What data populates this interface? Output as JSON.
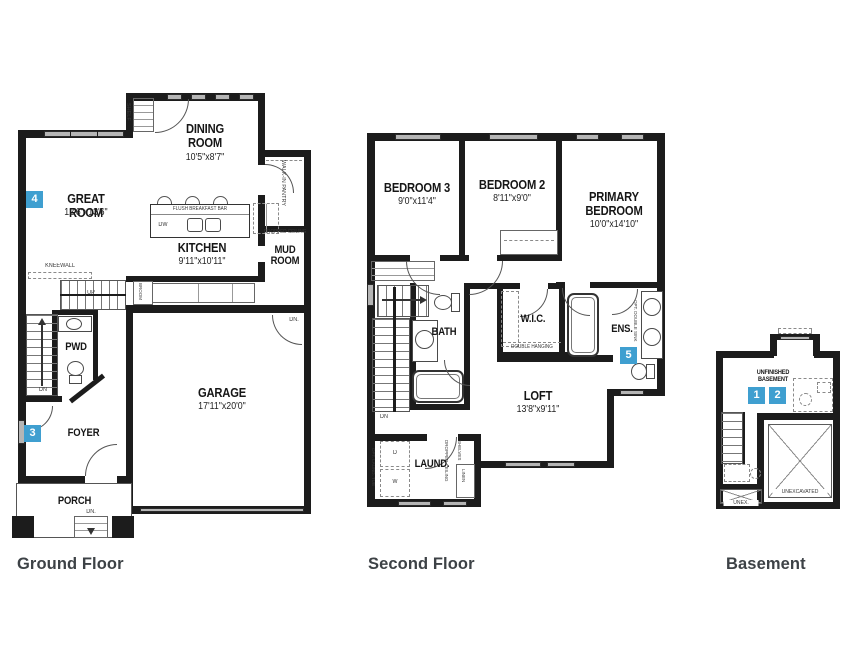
{
  "colors": {
    "wall": "#1c1c1c",
    "badge_blue": "#3f9fd0",
    "window_gray": "#b5b5b5",
    "title_gray": "#3d4246"
  },
  "floors": {
    "ground": {
      "title": "Ground Floor",
      "rooms": {
        "dining": {
          "name": "DINING\nROOM",
          "dims": "10'5\"x8'7\""
        },
        "great": {
          "badge": "4",
          "name": "GREAT ROOM",
          "dims": "12'6\"x13'6\""
        },
        "kitchen": {
          "name": "KITCHEN",
          "dims": "9'11\"x10'11\""
        },
        "mud": {
          "name": "MUD\nROOM"
        },
        "pwd": {
          "name": "PWD"
        },
        "foyer": {
          "badge": "3",
          "name": "FOYER"
        },
        "porch": {
          "name": "PORCH"
        },
        "garage": {
          "name": "GARAGE",
          "dims": "17'11\"x20'0\""
        }
      },
      "notes": {
        "kneewall": "KNEEWALL",
        "up": "UP",
        "dn": "DN",
        "dn_steps": "DN.",
        "dw": "DW",
        "breakfast_bar": "FLUSH BREAKFAST BAR",
        "pantry": "WALK-IN PANTRY",
        "broom": "BROOM",
        "shelf": "SHELF",
        "dropped_ceiling": "DROPPED CEILING"
      }
    },
    "second": {
      "title": "Second Floor",
      "rooms": {
        "bedroom3": {
          "name": "BEDROOM 3",
          "dims": "9'0\"x11'4\""
        },
        "bedroom2": {
          "name": "BEDROOM 2",
          "dims": "8'11\"x9'0\""
        },
        "primary": {
          "name": "PRIMARY\nBEDROOM",
          "dims": "10'0\"x14'10\""
        },
        "bath": {
          "name": "BATH"
        },
        "wic": {
          "name": "W.I.C.",
          "note": "DOUBLE HANGING"
        },
        "ens": {
          "badge": "5",
          "name": "ENS.",
          "note": "OPT. DOUBLE SINK"
        },
        "loft": {
          "name": "LOFT",
          "dims": "13'8\"x9'11\""
        },
        "laundry": {
          "name": "LAUND."
        }
      },
      "notes": {
        "dn": "DN",
        "washer": "W",
        "dryer": "D",
        "linen": "LINEN",
        "shelves": "SHELVES",
        "dropped_ceiling": "DROPPED CEILING",
        "opt_tub": "OPT. LAUND. TUB"
      }
    },
    "basement": {
      "title": "Basement",
      "rooms": {
        "unfinished": {
          "name": "UNFINISHED\nBASEMENT",
          "badge1": "1",
          "badge2": "2"
        },
        "unexcavated": {
          "name": "UNEXCAVATED"
        },
        "unex": {
          "name": "UNEX."
        }
      }
    }
  }
}
